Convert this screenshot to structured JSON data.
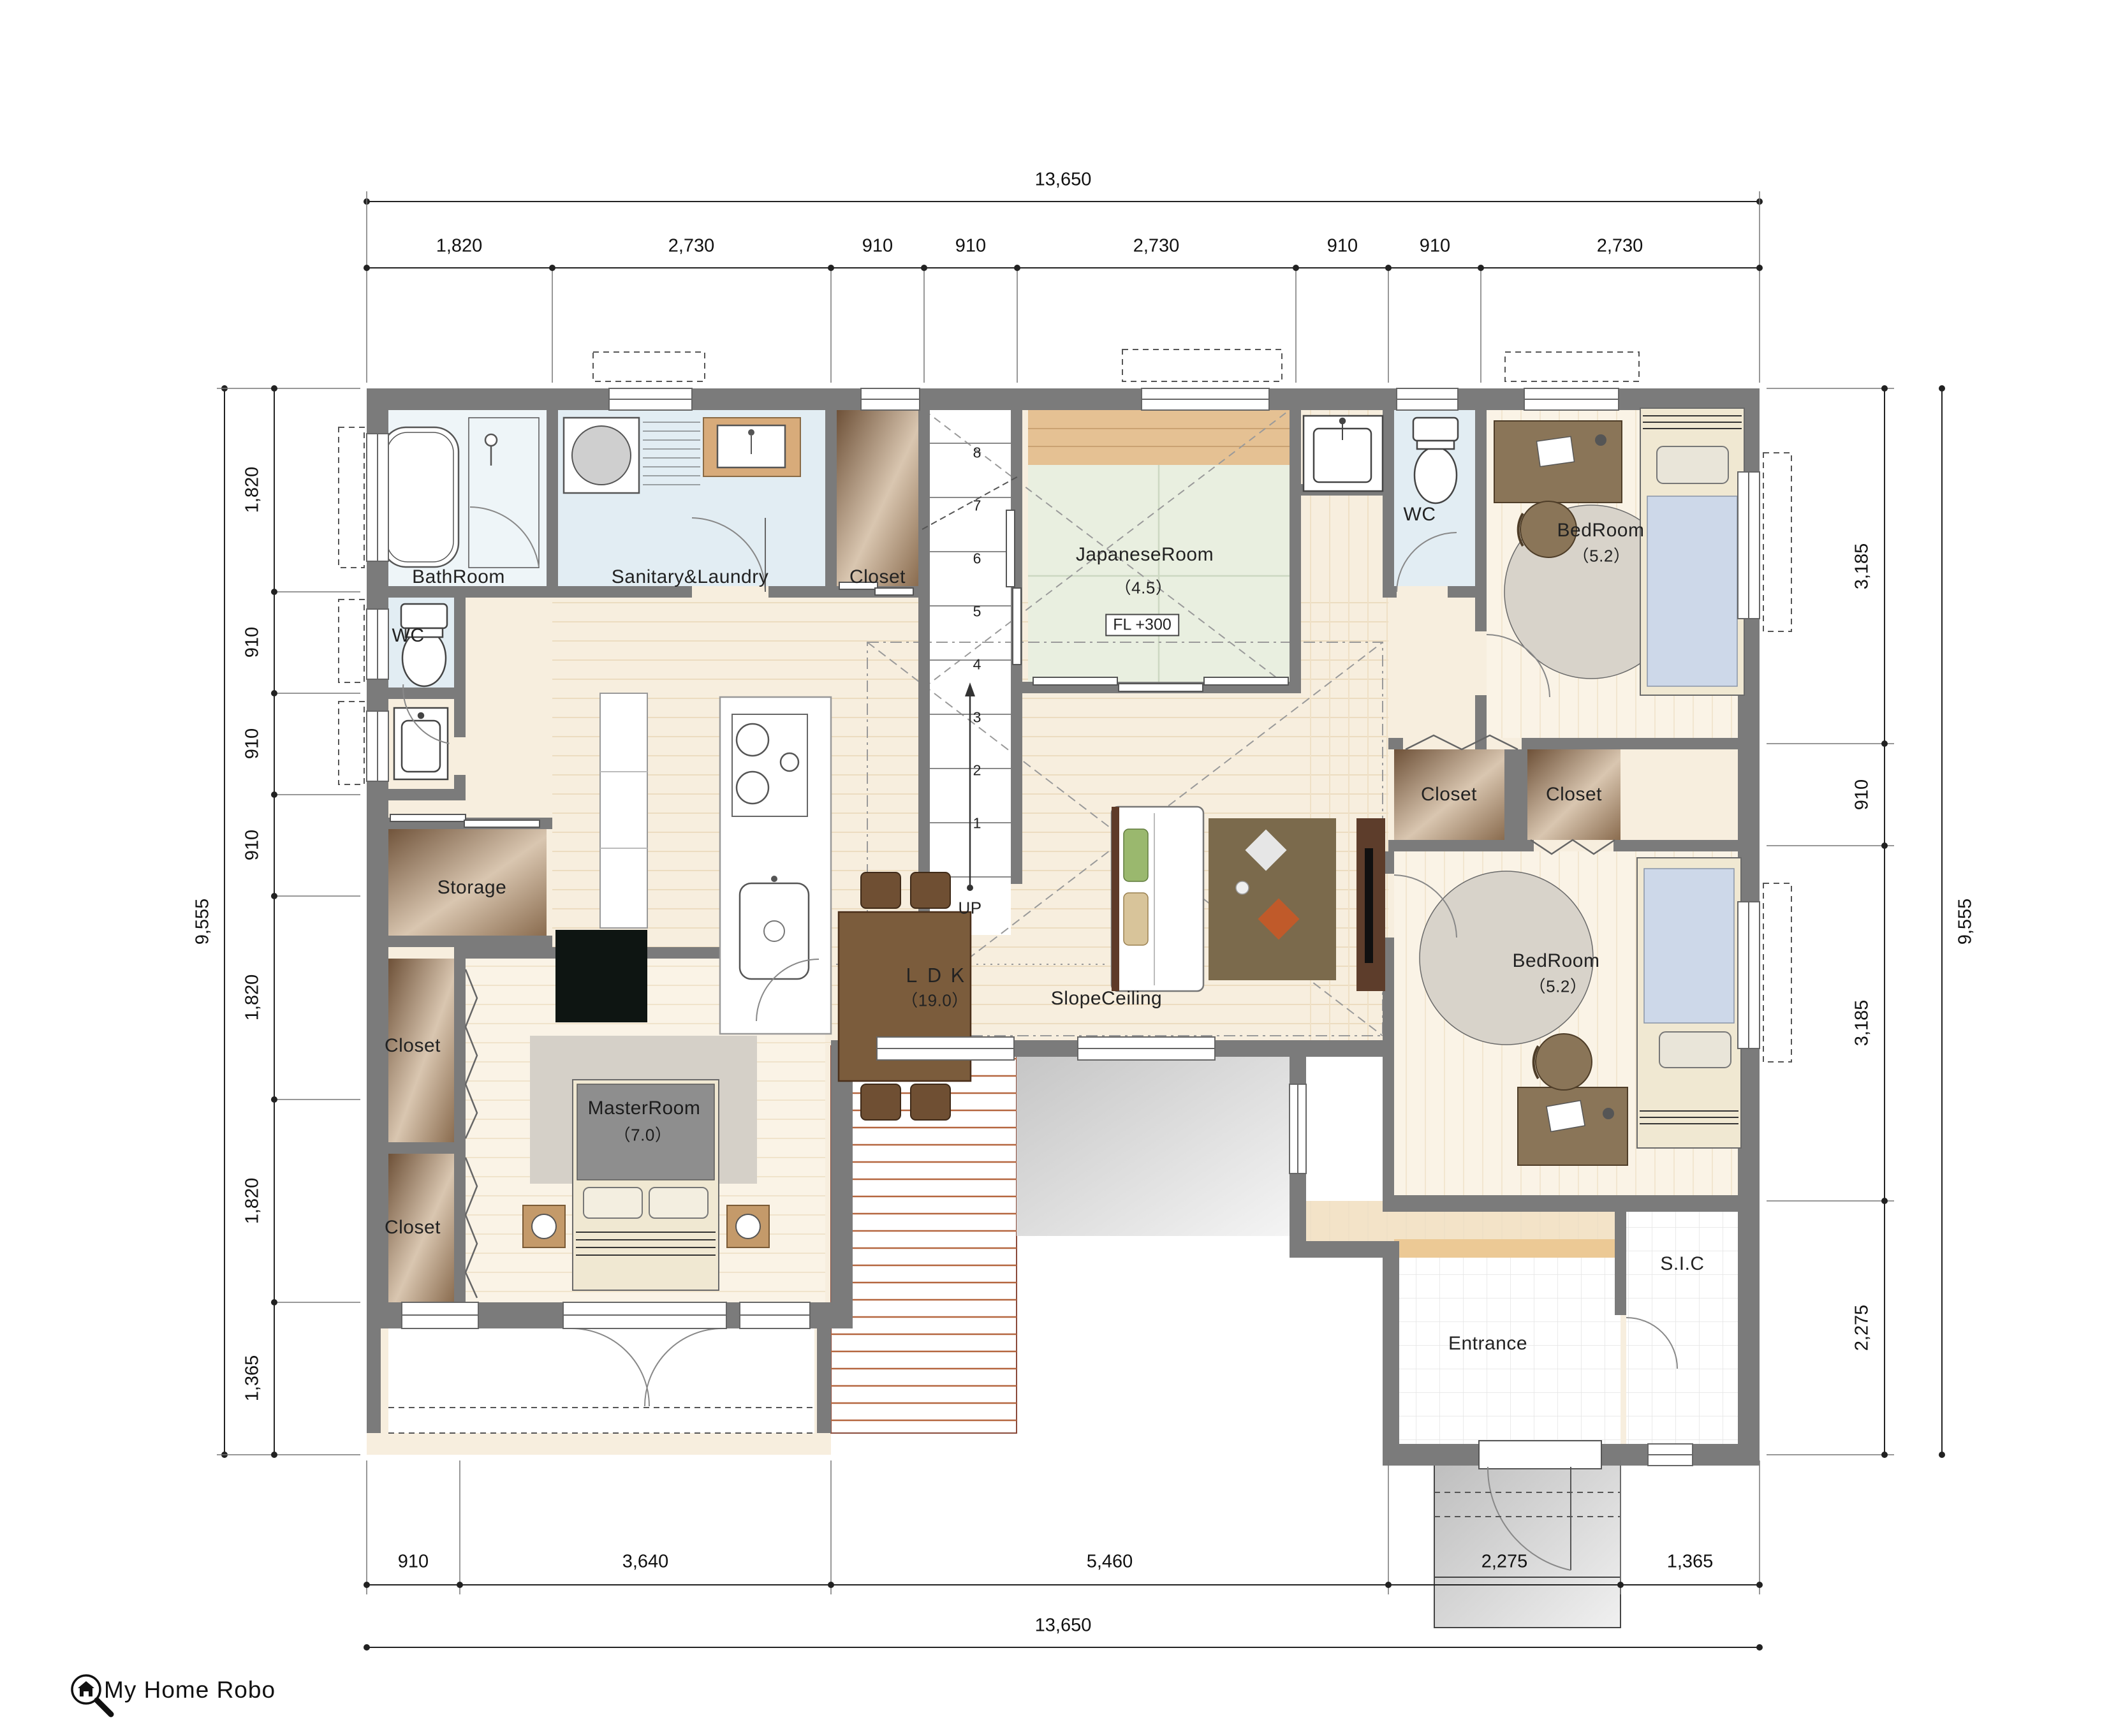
{
  "logo": {
    "text": "My Home Robo"
  },
  "dimensions": {
    "top": {
      "total": "13,650",
      "segments": [
        "1,820",
        "2,730",
        "910",
        "910",
        "2,730",
        "910",
        "910",
        "2,730"
      ]
    },
    "bottom": {
      "total": "13,650",
      "segments": [
        "910",
        "3,640",
        "5,460",
        "2,275",
        "1,365"
      ]
    },
    "left": {
      "total": "9,555",
      "segments": [
        "1,820",
        "910",
        "910",
        "910",
        "1,820",
        "1,820",
        "1,365"
      ]
    },
    "right": {
      "total": "9,555",
      "segments": [
        "3,185",
        "910",
        "3,185",
        "2,275"
      ]
    }
  },
  "rooms": {
    "bathroom": {
      "label": "BathRoom"
    },
    "sanitary": {
      "label": "Sanitary&Laundry"
    },
    "closet_top": {
      "label": "Closet"
    },
    "japanese": {
      "label": "JapaneseRoom",
      "area": "（4.5）",
      "floor_level": "FL +300"
    },
    "wc_top": {
      "label": "WC"
    },
    "bedroom1": {
      "label": "BedRoom",
      "area": "（5.2）"
    },
    "closet_mid_left": {
      "label": "Closet"
    },
    "closet_mid_right": {
      "label": "Closet"
    },
    "bedroom2": {
      "label": "BedRoom",
      "area": "（5.2）"
    },
    "wc_left": {
      "label": "WC"
    },
    "storage": {
      "label": "Storage"
    },
    "closet_bl_upper": {
      "label": "Closet"
    },
    "closet_bl_lower": {
      "label": "Closet"
    },
    "master": {
      "label": "MasterRoom",
      "area": "（7.0）"
    },
    "ldk": {
      "label": "ＬＤＫ",
      "area": "（19.0）"
    },
    "slope": {
      "label": "SlopeCeiling"
    },
    "entrance": {
      "label": "Entrance"
    },
    "sic": {
      "label": "S.I.C"
    }
  },
  "stairs": {
    "numbers": [
      "1",
      "2",
      "3",
      "4",
      "5",
      "6",
      "7",
      "8"
    ],
    "up": "UP"
  },
  "colors": {
    "wall": "#7b7b7b",
    "wet": "#e2edf3",
    "tatami": "#e9efe0",
    "wood": "#f7eede",
    "closet_dark": "#6e5138",
    "closet_light": "#e8d8c6",
    "terrace": "#cfcfcf",
    "deck_line": "#b5663f",
    "step": "#ecc995",
    "mattress": "#cdd8e9"
  }
}
